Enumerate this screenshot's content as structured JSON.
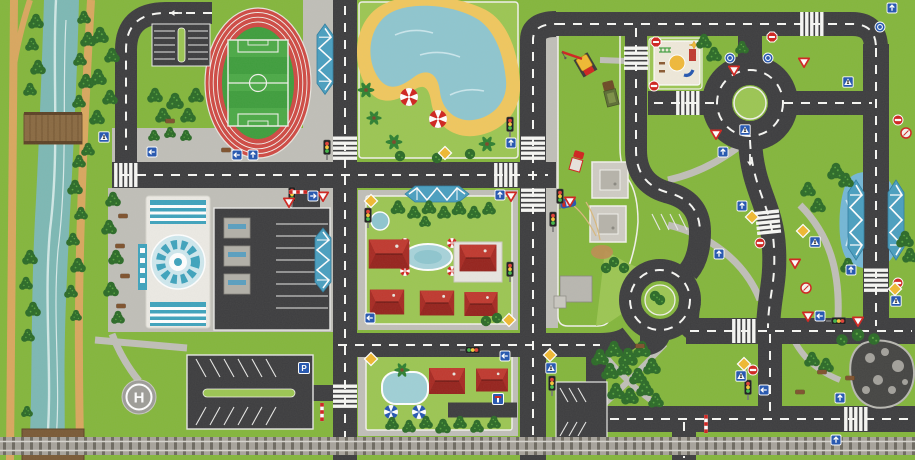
{
  "scene": {
    "kind": "children-city-road-play-mat",
    "helipad_label": "H",
    "parking_sign_label": "P"
  },
  "palette": {
    "grass": "#84b63c",
    "grass_light": "#9cc653",
    "road": "#3d3d3f",
    "marking": "#f7f7f4",
    "sidewalk": "#c0bfb8",
    "path_tan": "#d9a75f",
    "sand": "#f2dcae",
    "beach_sand": "#f0c75e",
    "river": "#7db8b4",
    "pool": "#8fc6cf",
    "canal": "#74b7d6",
    "track_red": "#cf4a44",
    "pitch_green": "#3f9e3d",
    "pitch_light": "#4caa47",
    "roof_red": "#c0392f",
    "teal": "#3fa3bd",
    "truss_blue": "#4a9fc0",
    "building_gray": "#b2b0a8",
    "rail_base": "#a8a49c",
    "rail_tie": "#6e6a61",
    "tree": "#2c6b28",
    "tree_light": "#58a23f",
    "sign_blue": "#2456b0",
    "sign_yellow": "#f0b932",
    "sign_red": "#d0241f",
    "pond_dark": "#454543",
    "rock_gray": "#a3a19b",
    "wood": "#7a5a36",
    "playground_cream": "#efe9da",
    "white": "#f2f1ec"
  },
  "legend": {
    "landmarks": [
      "river-with-footpaths",
      "wooden-bridge",
      "athletics-stadium",
      "soccer-pitch",
      "swimming-lake-beach",
      "construction-sand-lot",
      "playground",
      "roundabout",
      "terminal-building",
      "central-parking",
      "south-parking",
      "mini-parking",
      "residential-block-north",
      "residential-block-south",
      "helipad",
      "southeast-park",
      "rocky-pond",
      "canal-truss-bridge",
      "railway-line"
    ],
    "road_elements": [
      "crosswalk",
      "dashed-center-line",
      "parking-bays",
      "traffic-light",
      "stop-sign",
      "yield-sign",
      "no-entry-sign",
      "blue-arrow-sign",
      "priority-diamond-sign",
      "pedestrian-sign",
      "parking-sign",
      "dead-end-sign",
      "crossing-barrier"
    ],
    "vehicles": [
      "crane-truck",
      "flatbed-truck",
      "box-truck",
      "blue-car"
    ]
  }
}
